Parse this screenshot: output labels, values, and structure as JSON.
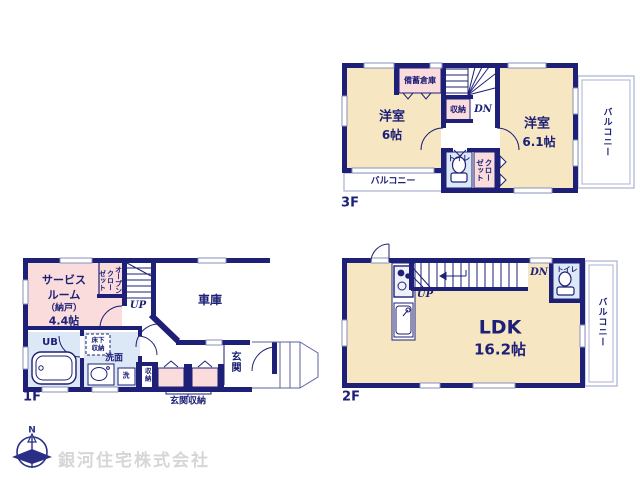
{
  "meta": {
    "company": "銀河住宅株式会社",
    "compass_n": "N"
  },
  "colors": {
    "wall": "#1d2076",
    "room_cream": "#f6e7c2",
    "room_pink": "#fadcdc",
    "room_blue": "#dce8f6",
    "balcony_line": "#a8b0d0",
    "window_line": "#8890b8",
    "watermark": "#d6d6d6"
  },
  "icons": [
    "compass-north-icon",
    "toilet-icon",
    "bathtub-icon",
    "stove-icon",
    "kitchen-sink-icon",
    "washbasin-icon",
    "stairs-icon",
    "door-arc-icon"
  ],
  "f3": {
    "label": "3F",
    "room1_name": "洋室",
    "room1_size": "6帖",
    "room2_name": "洋室",
    "room2_size": "6.1帖",
    "bichiku": "備蓄倉庫",
    "shunou": "収納",
    "dn": "DN",
    "toilet": "トイレ",
    "closet_col1": "クロー",
    "closet_col2": "ゼット",
    "balcony_bottom": "バルコニー",
    "balcony_right": "バルコニー"
  },
  "f2": {
    "label": "2F",
    "ldk_name": "LDK",
    "ldk_size": "16.2帖",
    "up": "UP",
    "dn": "DN",
    "toilet": "トイレ",
    "balcony": "バルコニー"
  },
  "f1": {
    "label": "1F",
    "service_line1": "サービス",
    "service_line2": "ルーム",
    "service_line3": "（納戸）",
    "service_line4": "4.4帖",
    "open_closet_col1": "オープン",
    "open_closet_col2": "クロー",
    "open_closet_col3": "ゼット",
    "up": "UP",
    "garage": "車庫",
    "ub": "UB",
    "yukashita_line1": "床下",
    "yukashita_line2": "収納",
    "senmen": "洗面",
    "laundry": "洗",
    "shunou": "収納",
    "genkan": "玄関",
    "genkan_shunou": "玄関収納"
  }
}
